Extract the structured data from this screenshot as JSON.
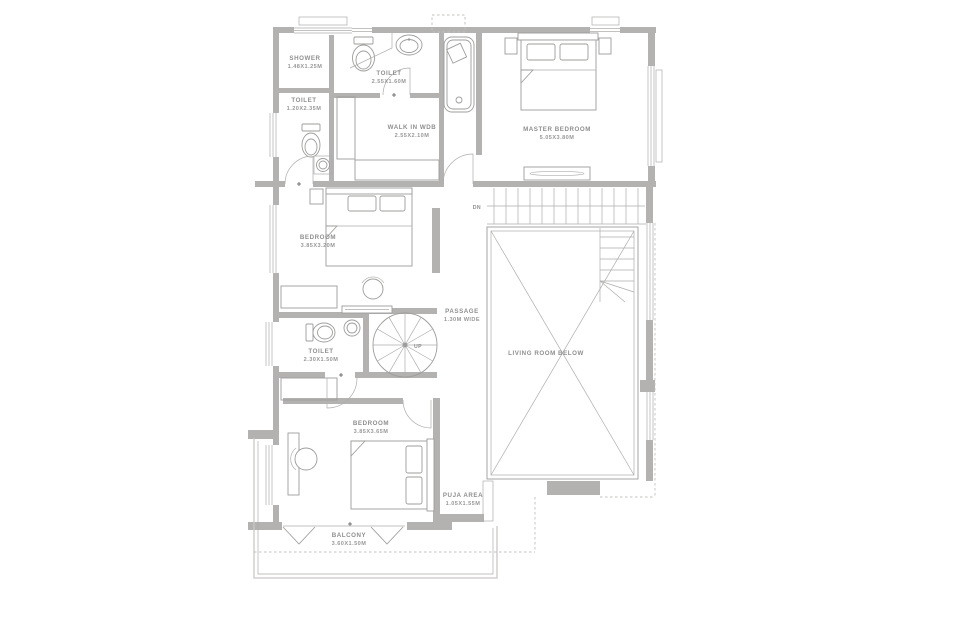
{
  "plan": {
    "type": "architectural-floor-plan",
    "colors": {
      "wall": "#b3b2b0",
      "line": "#9e9d9b",
      "text": "#8f8f8f",
      "background": "#ffffff"
    },
    "rooms": [
      {
        "name": "SHOWER",
        "dims": "1.48X1.25M"
      },
      {
        "name": "TOILET",
        "dims": "2.55X1.60M"
      },
      {
        "name": "TOILET",
        "dims": "1.20X2.35M"
      },
      {
        "name": "WALK IN WDB",
        "dims": "2.55X2.10M"
      },
      {
        "name": "MASTER BEDROOM",
        "dims": "5.05X3.80M"
      },
      {
        "name": "BEDROOM",
        "dims": "3.85X3.20M"
      },
      {
        "name": "PASSAGE",
        "dims": "1.30M WIDE"
      },
      {
        "name": "TOILET",
        "dims": "2.30X1.50M"
      },
      {
        "name": "LIVING ROOM BELOW",
        "dims": ""
      },
      {
        "name": "BEDROOM",
        "dims": "3.85X3.65M"
      },
      {
        "name": "PUJA AREA",
        "dims": "1.05X1.55M"
      },
      {
        "name": "BALCONY",
        "dims": "3.60X1.50M"
      }
    ],
    "stairs": {
      "down": "DN",
      "up": "UP"
    }
  }
}
